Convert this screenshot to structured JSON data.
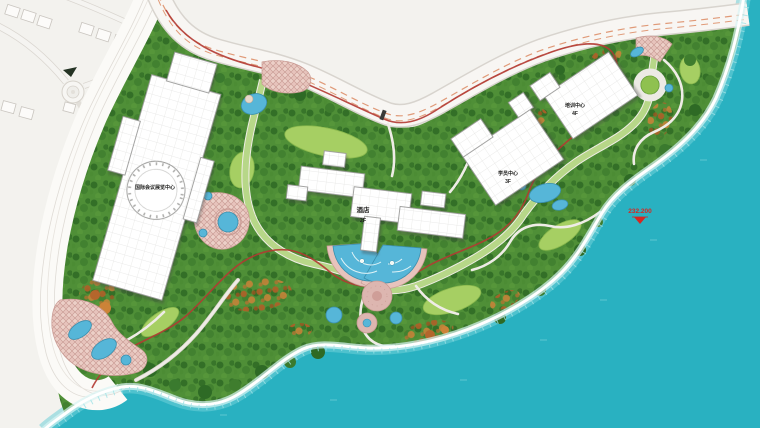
{
  "colors": {
    "water": "#29b1c1",
    "shallow": "#6fd0d8",
    "foam": "#ffffff",
    "offsite": "#f3f2ee",
    "beach": "#fbfaf7",
    "beach_line": "#dfdbd5",
    "road_fill": "#f8f6f3",
    "road_edge": "#d8d4ce",
    "lane_dash": "#e09a78",
    "green_base": "#4f8f37",
    "green_dark": "#2e6a25",
    "lawn": "#a6cf63",
    "autumn": "#b4662c",
    "plaza": "#e7c3bc",
    "plaza_line": "#c89a93",
    "pool": "#56b6d8",
    "pool_edge": "#3a8fae",
    "building": "#ffffff",
    "building_edge": "#9b9b99",
    "green_road": "#b7d788",
    "path_fill": "#efece6",
    "red_track": "#b23a32",
    "marker_red": "#d42822",
    "label": "#222220"
  },
  "buildings": {
    "conference_center": {
      "label": "国际会议展览中心"
    },
    "hotel": {
      "label": "酒店",
      "floors": "2F"
    },
    "trainee_center": {
      "label": "学员中心",
      "floors": "3F"
    },
    "training_center": {
      "label": "培训中心",
      "floors": "4F"
    }
  },
  "markers": {
    "water_level": {
      "value": "232.200"
    }
  }
}
